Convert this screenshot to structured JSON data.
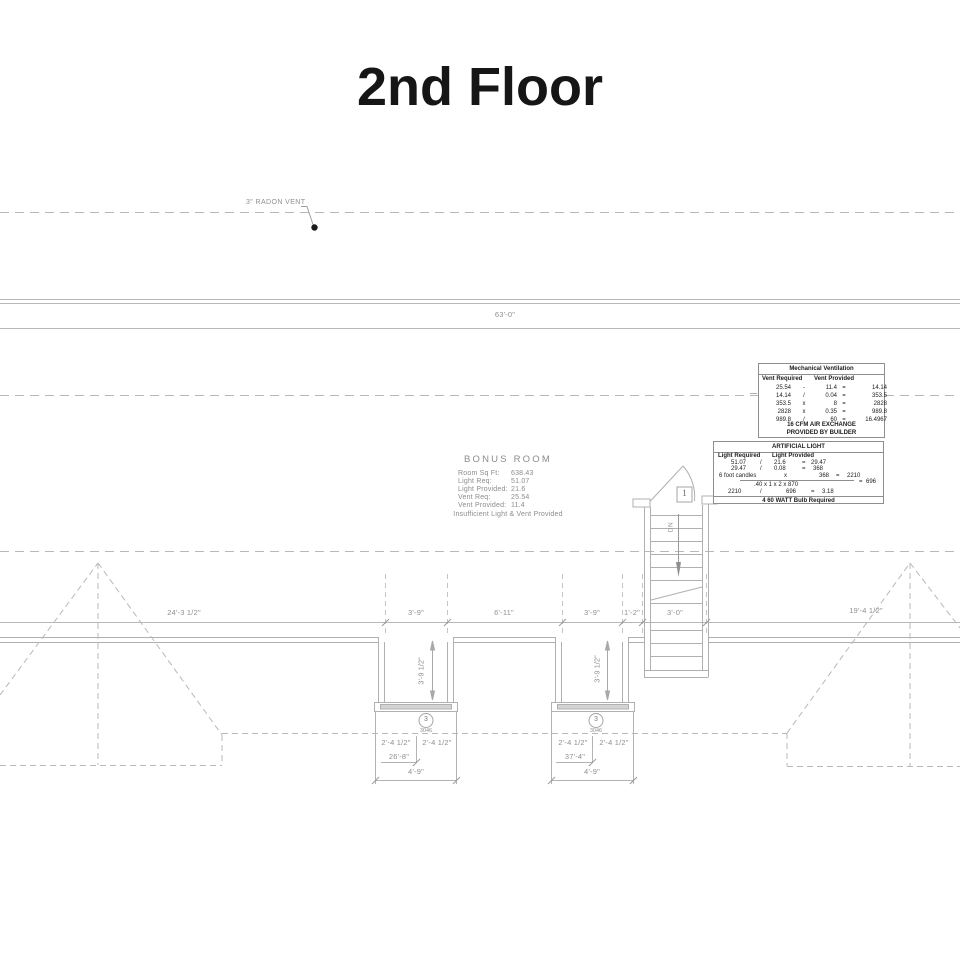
{
  "title": "2nd Floor",
  "labels": {
    "radon_vent": "3\" RADON VENT",
    "overall": "63'-0\"",
    "dn": "DN",
    "door_tag": "1"
  },
  "mech_table": {
    "title": "Mechanical Ventilation",
    "col_required": "Vent Required",
    "col_provided": "Vent Provided",
    "rows": [
      [
        "25.54",
        "-",
        "11.4",
        "=",
        "14.14"
      ],
      [
        "14.14",
        "/",
        "0.04",
        "=",
        "353.5"
      ],
      [
        "353.5",
        "x",
        "8",
        "=",
        "2828"
      ],
      [
        "2828",
        "x",
        "0.35",
        "=",
        "989.8"
      ],
      [
        "989.8",
        "/",
        "60",
        "=",
        "16.4967"
      ]
    ],
    "footer_line1": "16   CFM AIR EXCHANGE",
    "footer_line2": "PROVIDED BY BUILDER"
  },
  "light_table": {
    "title": "ARTIFICIAL LIGHT",
    "col_required": "Light Required",
    "col_provided": "Light Provided",
    "r1": [
      "51.07",
      "/",
      "21.6",
      "=",
      "29.47"
    ],
    "r2": [
      "29.47",
      "/",
      "0.08",
      "=",
      "368"
    ],
    "r3": [
      "6 foot candles",
      "x",
      "368",
      "=",
      "2210"
    ],
    "r4": [
      ".40 x 1 x 2 x 870",
      "=",
      "696"
    ],
    "r5": [
      "2210",
      "/",
      "696",
      "=",
      "3.18"
    ],
    "footer": "4   60 WATT Bulb Required"
  },
  "bonus_room": {
    "title": "BONUS ROOM",
    "rows": [
      {
        "label": "Room Sq Ft:",
        "value": "638.43"
      },
      {
        "label": "Light Req:",
        "value": "51.07"
      },
      {
        "label": "Light Provided:",
        "value": "21.6"
      },
      {
        "label": "Vent Req:",
        "value": "25.54"
      },
      {
        "label": "Vent Provided:",
        "value": "11.4"
      }
    ],
    "note": "Insufficient Light & Vent Provided"
  },
  "dims": {
    "left_span": "24'-3 1/2\"",
    "right_span": "19'-4 1/2\"",
    "d1": "3'-9\"",
    "d2": "6'-11\"",
    "d3": "3'-9\"",
    "d4": "1'-2\"",
    "d5": "3'-0\"",
    "alcove_depth": "3'-9 1/2\"",
    "win_half": "2'-4 1/2\"",
    "run_left": "26'-8\"",
    "run_right": "37'-4\"",
    "win_width": "4'-9\""
  },
  "window_tag": {
    "number": "3",
    "size": "3046"
  }
}
